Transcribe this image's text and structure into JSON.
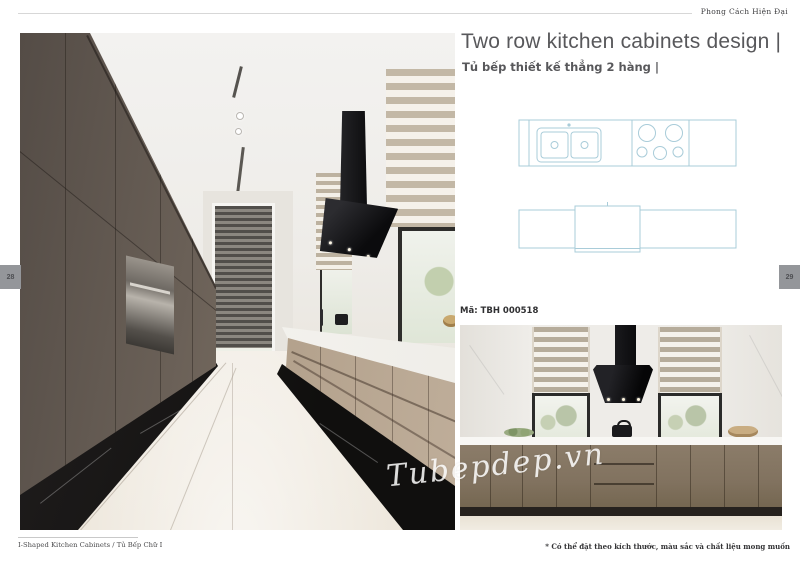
{
  "header": {
    "tagline": "Phong Cách Hiện Đại"
  },
  "hero": {
    "title": "Two row kitchen cabinets design |",
    "subtitle": "Tủ bếp thiết kế thẳng 2 hàng |"
  },
  "product": {
    "code": "Mã: TBH 000518"
  },
  "watermark": "Tubepdep.vn",
  "page_numbers": {
    "left": "28",
    "right": "29"
  },
  "footer": {
    "left": "I-Shaped Kitchen Cabinets / Tủ Bếp Chữ I",
    "right": "* Có thể đặt theo kích thước, màu sắc và chất liệu mong muốn"
  },
  "drawings": {
    "plan_view": "countertop plan: double sink with faucet and 5-burner hob",
    "elevation_view": "second row elevation: three cabinet modules"
  },
  "colors": {
    "blueprint_line": "#a9ccd9",
    "title_text": "#58585b",
    "tab_background": "#94969a",
    "cabinet_dark": "#6a6057",
    "cabinet_beige": "#8b7c69"
  }
}
